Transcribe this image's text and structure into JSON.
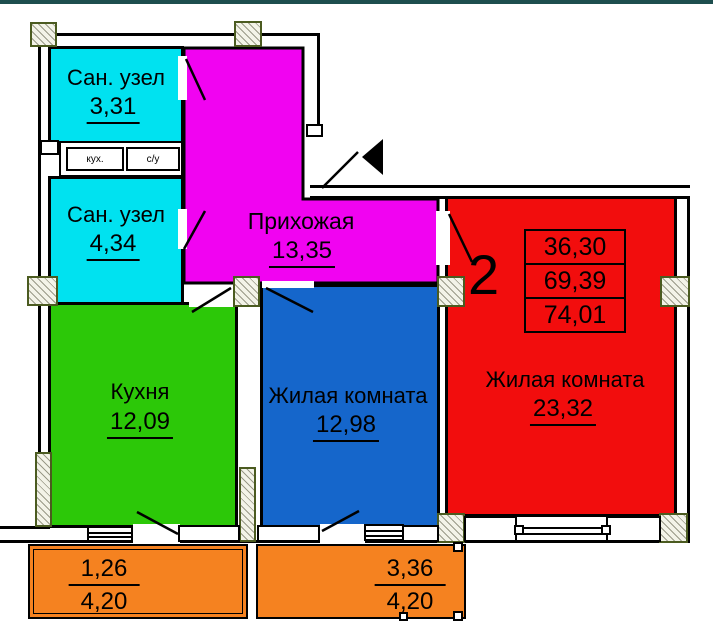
{
  "plan": {
    "top_bar_color": "#1d4e4e",
    "rooms": [
      {
        "id": "sanuzel-1",
        "name": "Сан. узел",
        "area": "3,31",
        "color": "#00e2f0"
      },
      {
        "id": "sanuzel-2",
        "name": "Сан. узел",
        "area": "4,34",
        "color": "#00e2f0"
      },
      {
        "id": "hallway",
        "name": "Прихожая",
        "area": "13,35",
        "color": "#f103f1"
      },
      {
        "id": "kitchen",
        "name": "Кухня",
        "area": "12,09",
        "color": "#2cc808"
      },
      {
        "id": "living-1",
        "name": "Жилая комната",
        "area": "12,98",
        "color": "#1566cb"
      },
      {
        "id": "living-2",
        "name": "Жилая комната",
        "area": "23,32",
        "color": "#f20d0d"
      }
    ],
    "vents": {
      "kitchen": "кух.",
      "bath": "с/у"
    },
    "summary": {
      "rooms_count": "2",
      "living_area": "36,30",
      "area_without_balcony": "69,39",
      "total_area": "74,01"
    },
    "balconies": [
      {
        "id": "balcony-left",
        "reduced_area": "1,26",
        "full_area": "4,20",
        "color": "#f58220"
      },
      {
        "id": "balcony-right",
        "reduced_area": "3,36",
        "full_area": "4,20",
        "color": "#f58220"
      }
    ]
  }
}
